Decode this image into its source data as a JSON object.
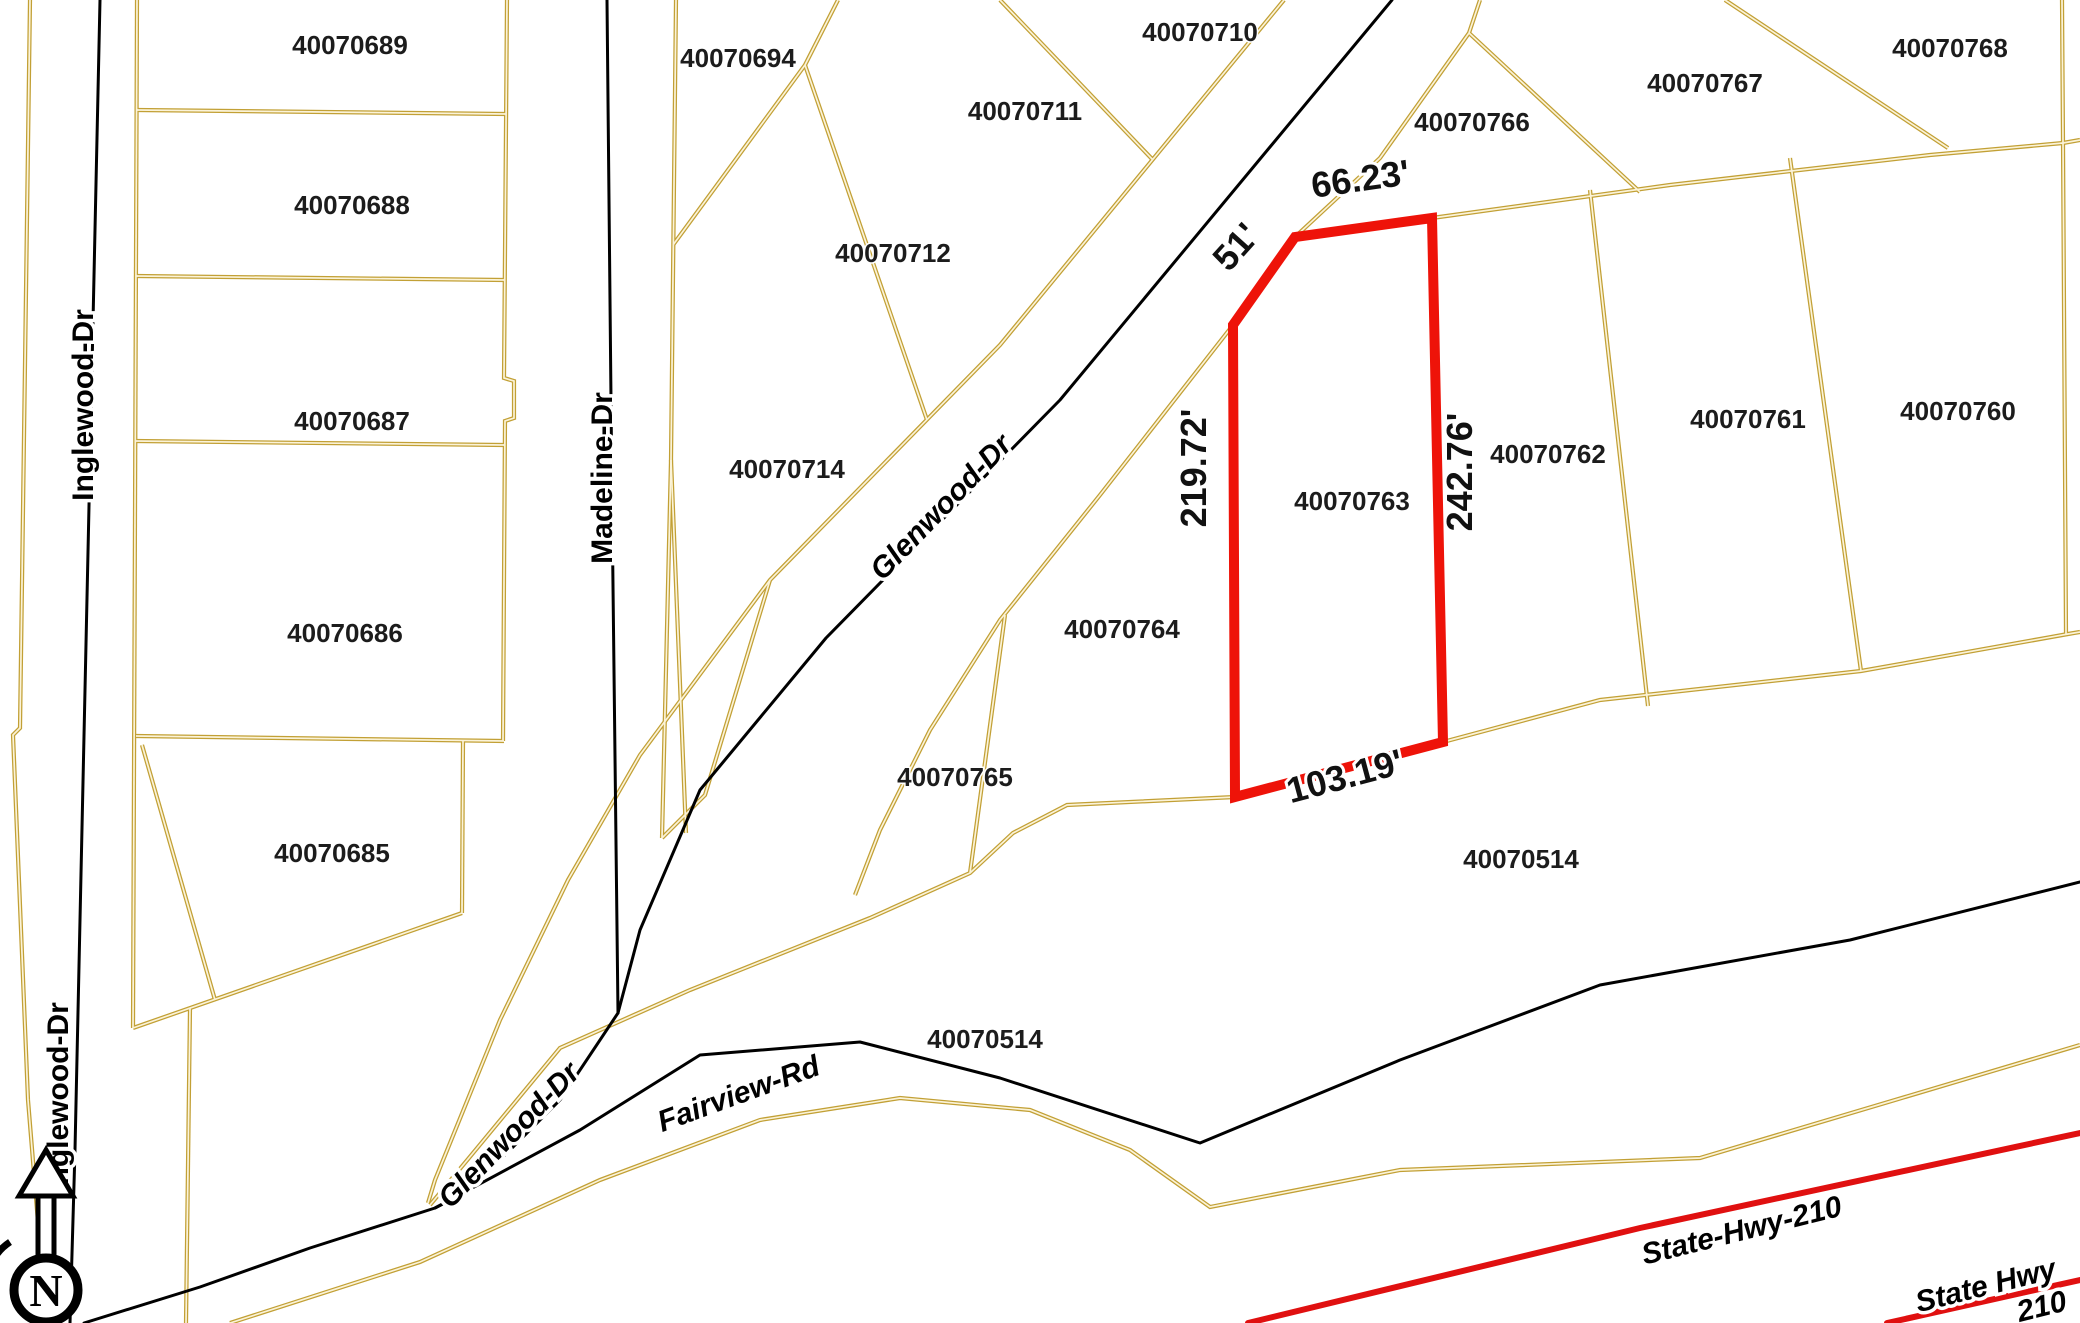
{
  "map": {
    "kind": "county parcel / plat GIS map",
    "canvas": {
      "width": 2080,
      "height": 1323,
      "background": "#ffffff"
    },
    "colors": {
      "parcel_line": "#C2A035",
      "parcel_line_core": "#FBF3D8",
      "road_line": "#000000",
      "highway_line": "#E01010",
      "selected_parcel": "#EE1309",
      "label_text": "#1c1c1c"
    },
    "selected_parcel": {
      "id": "40070763",
      "outline_points": [
        [
          1233,
          325
        ],
        [
          1295,
          237
        ],
        [
          1432,
          218
        ],
        [
          1443,
          742
        ],
        [
          1235,
          797
        ]
      ],
      "stroke_width": 10,
      "dimensions": [
        {
          "text": "51'",
          "x": 1245,
          "y": 255,
          "rot": -48
        },
        {
          "text": "66.23'",
          "x": 1362,
          "y": 191,
          "rot": -8
        },
        {
          "text": "219.72'",
          "x": 1206,
          "y": 468,
          "rot": -90
        },
        {
          "text": "242.76'",
          "x": 1472,
          "y": 472,
          "rot": -90
        },
        {
          "text": "103.19'",
          "x": 1348,
          "y": 788,
          "rot": -15
        }
      ]
    },
    "parcel_labels": [
      {
        "text": "40070689",
        "x": 350,
        "y": 54
      },
      {
        "text": "40070688",
        "x": 352,
        "y": 214
      },
      {
        "text": "40070687",
        "x": 352,
        "y": 430
      },
      {
        "text": "40070686",
        "x": 345,
        "y": 642
      },
      {
        "text": "40070685",
        "x": 332,
        "y": 862
      },
      {
        "text": "40070694",
        "x": 738,
        "y": 67
      },
      {
        "text": "40070711",
        "x": 1025,
        "y": 120
      },
      {
        "text": "40070710",
        "x": 1200,
        "y": 41
      },
      {
        "text": "40070712",
        "x": 893,
        "y": 262
      },
      {
        "text": "40070714",
        "x": 787,
        "y": 478
      },
      {
        "text": "40070766",
        "x": 1472,
        "y": 131
      },
      {
        "text": "40070767",
        "x": 1705,
        "y": 92
      },
      {
        "text": "40070768",
        "x": 1950,
        "y": 57
      },
      {
        "text": "40070760",
        "x": 1958,
        "y": 420
      },
      {
        "text": "40070761",
        "x": 1748,
        "y": 428
      },
      {
        "text": "40070762",
        "x": 1548,
        "y": 463
      },
      {
        "text": "40070763",
        "x": 1352,
        "y": 510
      },
      {
        "text": "40070764",
        "x": 1122,
        "y": 638
      },
      {
        "text": "40070765",
        "x": 955,
        "y": 786
      },
      {
        "text": "40070514",
        "x": 1521,
        "y": 868
      },
      {
        "text": "40070514",
        "x": 985,
        "y": 1048
      }
    ],
    "roads": [
      {
        "name": "Inglewood Dr",
        "points": [
          [
            100,
            0
          ],
          [
            75,
            1150
          ],
          [
            70,
            1323
          ]
        ]
      },
      {
        "name": "Madeline Dr",
        "points": [
          [
            607,
            0
          ],
          [
            612,
            500
          ],
          [
            618,
            1013
          ]
        ]
      },
      {
        "name": "Glenwood Dr",
        "points": [
          [
            1392,
            0
          ],
          [
            1060,
            400
          ],
          [
            826,
            638
          ],
          [
            700,
            790
          ],
          [
            640,
            930
          ],
          [
            618,
            1013
          ],
          [
            560,
            1100
          ],
          [
            470,
            1190
          ],
          [
            435,
            1208
          ]
        ]
      },
      {
        "name": "Fairview Rd",
        "points": [
          [
            84,
            1323
          ],
          [
            200,
            1287
          ],
          [
            310,
            1248
          ],
          [
            435,
            1208
          ],
          [
            580,
            1130
          ],
          [
            700,
            1055
          ],
          [
            860,
            1042
          ],
          [
            1000,
            1078
          ],
          [
            1200,
            1143
          ],
          [
            1400,
            1060
          ],
          [
            1600,
            985
          ],
          [
            1850,
            940
          ],
          [
            2080,
            882
          ]
        ]
      }
    ],
    "street_labels": [
      {
        "text": "Inglewood-Dr",
        "x": 93,
        "y": 405,
        "rot": -90,
        "italic": false
      },
      {
        "text": "Inglewood-Dr",
        "x": 68,
        "y": 1098,
        "rot": -90,
        "italic": false
      },
      {
        "text": "Madeline-Dr",
        "x": 612,
        "y": 478,
        "rot": -90,
        "italic": false
      },
      {
        "text": "Glenwood-Dr",
        "x": 948,
        "y": 514,
        "rot": -46,
        "italic": true
      },
      {
        "text": "Glenwood-Dr",
        "x": 516,
        "y": 1142,
        "rot": -46,
        "italic": true
      },
      {
        "text": "Fairview-Rd",
        "x": 742,
        "y": 1103,
        "rot": -20,
        "italic": true
      },
      {
        "text": "State-Hwy-210",
        "x": 1744,
        "y": 1240,
        "rot": -14,
        "italic": true
      },
      {
        "text": "State Hwy",
        "x": 1988,
        "y": 1295,
        "rot": -14,
        "italic": true
      },
      {
        "text": "210",
        "x": 2044,
        "y": 1316,
        "rot": -14,
        "italic": true
      }
    ],
    "highway_lines": [
      {
        "name": "State Hwy 210",
        "points": [
          [
            1248,
            1323
          ],
          [
            1640,
            1228
          ],
          [
            2080,
            1133
          ]
        ]
      },
      {
        "name": "State Hwy 210 ramp",
        "points": [
          [
            1887,
            1323
          ],
          [
            2080,
            1280
          ]
        ]
      }
    ],
    "parcel_lines": [
      [
        [
          30,
          0
        ],
        [
          20,
          728
        ],
        [
          13,
          735
        ],
        [
          28,
          1100
        ],
        [
          46,
          1320
        ]
      ],
      [
        [
          137,
          0
        ],
        [
          133,
          1028
        ]
      ],
      [
        [
          133,
          1028
        ],
        [
          462,
          913
        ]
      ],
      [
        [
          142,
          745
        ],
        [
          215,
          1000
        ]
      ],
      [
        [
          190,
          1008
        ],
        [
          186,
          1323
        ]
      ],
      [
        [
          137,
          110
        ],
        [
          506,
          114
        ]
      ],
      [
        [
          136,
          276
        ],
        [
          505,
          280
        ]
      ],
      [
        [
          135,
          441
        ],
        [
          504,
          445
        ]
      ],
      [
        [
          136,
          736
        ],
        [
          504,
          741
        ]
      ],
      [
        [
          507,
          0
        ],
        [
          504,
          378
        ],
        [
          514,
          381
        ],
        [
          514,
          418
        ],
        [
          505,
          421
        ],
        [
          503,
          741
        ]
      ],
      [
        [
          463,
          741
        ],
        [
          462,
          913
        ]
      ],
      [
        [
          676,
          0
        ],
        [
          671,
          460
        ],
        [
          662,
          838
        ]
      ],
      [
        [
          671,
          460
        ],
        [
          686,
          833
        ]
      ],
      [
        [
          838,
          0
        ],
        [
          805,
          65
        ],
        [
          673,
          245
        ]
      ],
      [
        [
          805,
          65
        ],
        [
          927,
          420
        ]
      ],
      [
        [
          1000,
          0
        ],
        [
          1153,
          160
        ]
      ],
      [
        [
          1284,
          0
        ],
        [
          1000,
          345
        ],
        [
          770,
          580
        ],
        [
          640,
          755
        ],
        [
          568,
          880
        ],
        [
          500,
          1020
        ],
        [
          435,
          1180
        ],
        [
          428,
          1203
        ]
      ],
      [
        [
          1480,
          0
        ],
        [
          1469,
          33
        ],
        [
          1380,
          158
        ],
        [
          1295,
          237
        ],
        [
          1233,
          325
        ],
        [
          1100,
          495
        ],
        [
          1000,
          620
        ],
        [
          930,
          730
        ],
        [
          880,
          830
        ],
        [
          855,
          895
        ]
      ],
      [
        [
          1469,
          33
        ],
        [
          1640,
          192
        ]
      ],
      [
        [
          1725,
          0
        ],
        [
          1948,
          148
        ]
      ],
      [
        [
          1432,
          218
        ],
        [
          1670,
          185
        ],
        [
          1930,
          155
        ],
        [
          2063,
          143
        ],
        [
          2080,
          140
        ]
      ],
      [
        [
          1590,
          190
        ],
        [
          1648,
          706
        ]
      ],
      [
        [
          1790,
          158
        ],
        [
          1861,
          671
        ]
      ],
      [
        [
          2062,
          0
        ],
        [
          2063,
          142
        ],
        [
          2066,
          634
        ]
      ],
      [
        [
          1235,
          797
        ],
        [
          1067,
          805
        ],
        [
          1013,
          833
        ],
        [
          970,
          873
        ],
        [
          870,
          918
        ],
        [
          690,
          990
        ],
        [
          560,
          1048
        ],
        [
          430,
          1205
        ]
      ],
      [
        [
          1005,
          615
        ],
        [
          970,
          873
        ]
      ],
      [
        [
          1443,
          742
        ],
        [
          1600,
          700
        ],
        [
          1861,
          671
        ],
        [
          2068,
          634
        ],
        [
          2080,
          632
        ]
      ],
      [
        [
          662,
          838
        ],
        [
          705,
          795
        ],
        [
          770,
          580
        ]
      ],
      [
        [
          230,
          1323
        ],
        [
          420,
          1262
        ],
        [
          600,
          1180
        ],
        [
          760,
          1120
        ],
        [
          900,
          1098
        ],
        [
          1030,
          1110
        ],
        [
          1130,
          1150
        ],
        [
          1210,
          1207
        ],
        [
          1400,
          1170
        ],
        [
          1700,
          1158
        ],
        [
          1895,
          1100
        ],
        [
          2080,
          1045
        ]
      ]
    ],
    "north_arrow": {
      "x": 46,
      "y": 1262,
      "letter": "N"
    },
    "font_sizes": {
      "parcel": 26,
      "street": 30,
      "dimension": 36
    }
  }
}
